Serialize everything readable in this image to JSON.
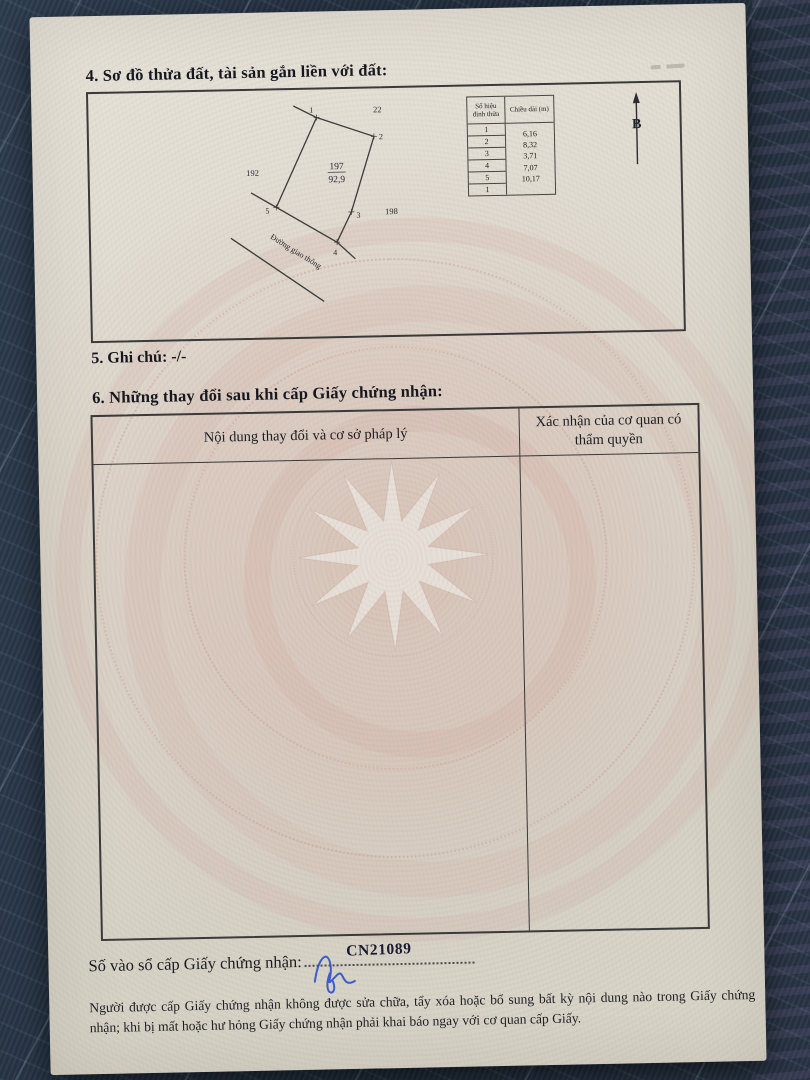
{
  "section4": {
    "heading": "4. Sơ đồ thửa đất, tài sản gắn liền với đất:"
  },
  "diagram": {
    "plot_number": "197",
    "plot_area": "92,9",
    "adjacent_plot_west": "192",
    "adjacent_plot_north": "22",
    "adjacent_plot_east": "198",
    "road_label": "Đường giao thông",
    "north_label": "B",
    "vertex_labels": [
      "1",
      "2",
      "3",
      "4",
      "5"
    ],
    "edge_table": {
      "col_vertex_header": "Số hiệu đỉnh thửa",
      "col_length_header": "Chiều dài (m)",
      "vertices": [
        "1",
        "2",
        "3",
        "4",
        "5",
        "1"
      ],
      "lengths": [
        "6,16",
        "8,32",
        "3,71",
        "7,07",
        "10,17"
      ]
    }
  },
  "section5": {
    "label": "5. Ghi chú:",
    "value": "-/-"
  },
  "section6": {
    "heading": "6. Những thay đổi sau khi cấp Giấy chứng nhận:",
    "table": {
      "col1_header": "Nội dung thay đổi và cơ sở pháp lý",
      "col2_header": "Xác nhận của cơ quan có thẩm quyền"
    }
  },
  "footer": {
    "registry_label": "Số vào sổ cấp Giấy chứng nhận:",
    "registry_number": "CN21089",
    "notice": "Người được cấp Giấy chứng nhận không được sửa chữa, tẩy xóa hoặc bổ sung bất kỳ nội dung nào trong Giấy chứng nhận; khi bị mất hoặc hư hỏng Giấy chứng nhận phải khai báo ngay với cơ quan cấp Giấy."
  },
  "colors": {
    "fabric": "#233040",
    "paper": "#dcd8cd",
    "guilloche_pink": "#cf968c",
    "ink": "#1d1e24",
    "signature_blue": "#2e52c4"
  }
}
